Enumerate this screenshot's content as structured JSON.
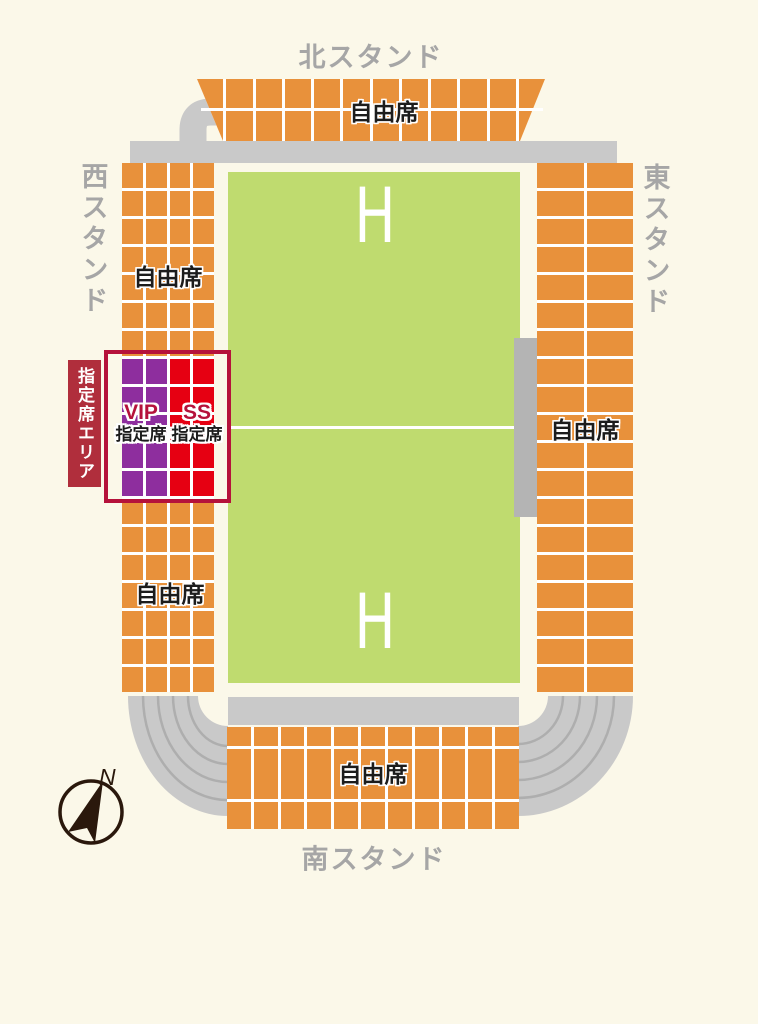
{
  "colors": {
    "background": "#FBF8E9",
    "seat_orange": "#E8913B",
    "vip_purple": "#8E2E9E",
    "ss_red": "#E60012",
    "accent_crimson": "#B5123B",
    "reserved_box_red": "#B02E3C",
    "field_green": "#BFDB6F",
    "track_gray": "#C9C9C9",
    "lane_gray": "#AEAEAE",
    "strip_gray": "#B4B4B4",
    "stand_label_gray": "#A6A6A6",
    "seat_text_black": "#1C1C1C",
    "compass_dark": "#2A180C",
    "line_white": "#FFFFFF"
  },
  "labels": {
    "north_stand": "北スタンド",
    "south_stand": "南スタンド",
    "west_stand": "西スタンド",
    "east_stand": "東スタンド",
    "free_seat": "自由席",
    "reserved_area": "指定席エリア",
    "vip_code": "VIP",
    "ss_code": "SS",
    "reserved_seat": "指定席",
    "field_mark": "H",
    "compass_north": "N"
  },
  "grids": {
    "north": {
      "cols": 12,
      "rowHeights": [
        29,
        30
      ],
      "default": "seat_orange"
    },
    "west": {
      "cols": 4,
      "rows": 19,
      "rowH": 25,
      "default": "seat_orange",
      "zones": [
        {
          "r0": 7,
          "r1": 11,
          "c0": 0,
          "c1": 1,
          "color": "vip_purple"
        },
        {
          "r0": 7,
          "r1": 11,
          "c0": 2,
          "c1": 3,
          "color": "ss_red"
        }
      ]
    },
    "east": {
      "cols": 2,
      "rows": 19,
      "rowH": 25,
      "default": "seat_orange"
    },
    "south": {
      "cols": 11,
      "rowHeights": [
        19,
        50,
        27
      ],
      "default": "seat_orange"
    }
  }
}
